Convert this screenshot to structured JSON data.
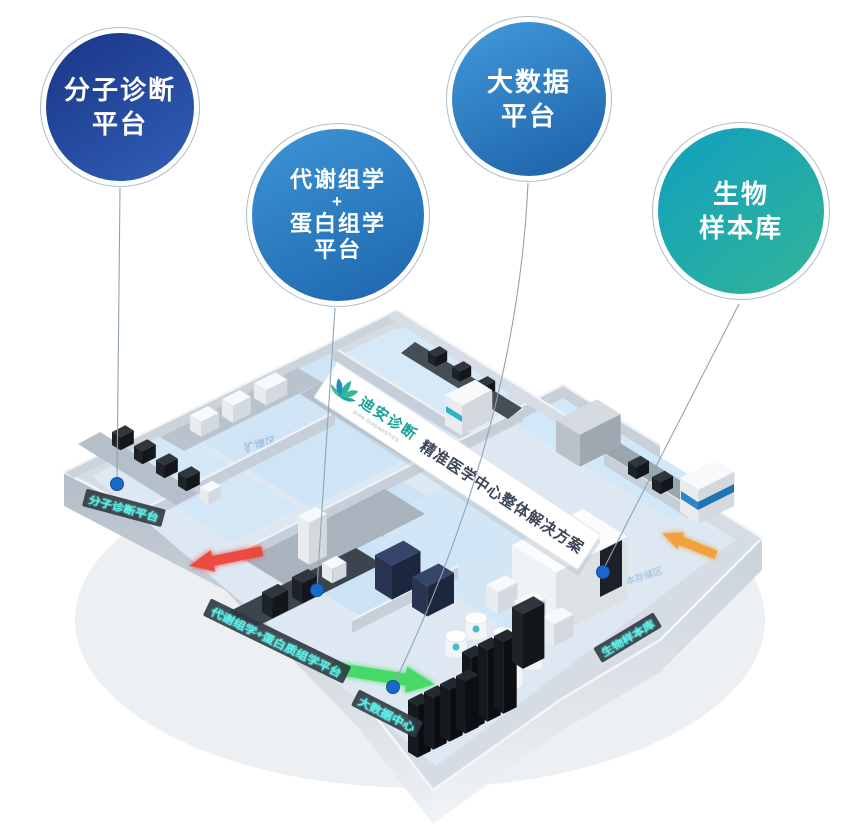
{
  "callouts": [
    {
      "id": "molecular-diagnostics",
      "lines": [
        "分子诊断",
        "平台"
      ],
      "gradient": [
        "#1c3a8c",
        "#2f5cb2"
      ]
    },
    {
      "id": "metabolomics-proteomics",
      "lines": [
        "代谢组学",
        "+",
        "蛋白组学",
        "平台"
      ],
      "gradient": [
        "#3b92d2",
        "#1f68b0"
      ]
    },
    {
      "id": "big-data",
      "lines": [
        "大数据",
        "平台"
      ],
      "gradient": [
        "#3f97d8",
        "#1e63a9"
      ]
    },
    {
      "id": "biobank",
      "lines": [
        "生物",
        "样本库"
      ],
      "gradient": [
        "#14a2bb",
        "#2fb39b"
      ]
    }
  ],
  "banner": {
    "brand": "迪安诊断",
    "brand_sub": "DIAN DIAGNOSTICS",
    "slogan": "精准医学中心整体解决方案"
  },
  "wall_labels": [
    {
      "id": "molecular-wall",
      "text": "分子诊断平台"
    },
    {
      "id": "omics-wall",
      "text": "代谢组学+蛋白质组学平台"
    },
    {
      "id": "datacenter-wall",
      "text": "大数据中心"
    },
    {
      "id": "biobank-wall",
      "text": "生物样本库"
    }
  ],
  "floor_labels": [
    {
      "id": "pcr-area",
      "text": "扩增区"
    },
    {
      "id": "lcms-area",
      "text": "色谱质谱区"
    },
    {
      "id": "storage-area",
      "text": "样本存储区"
    }
  ],
  "colors": {
    "led_text": "#5ef0e8",
    "leader_dot": "#1a68ce",
    "arrow_red": "#ef3b2d",
    "arrow_green": "#3fd95f",
    "arrow_orange": "#f59b2c",
    "brand_teal": "#1aa098",
    "slogan_dark": "#3c4858"
  }
}
